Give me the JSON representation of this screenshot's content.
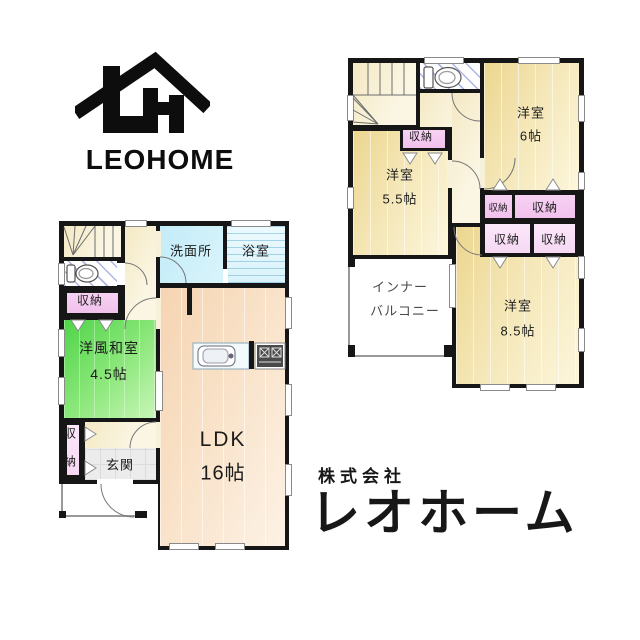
{
  "logo": {
    "brand": "LEOHOME"
  },
  "company": {
    "prefix": "株式会社",
    "name": "レオホーム"
  },
  "labels": {
    "closet": "収納",
    "closet_v_top": "収",
    "closet_v_bottom": "納",
    "washroom": "洗面所",
    "bathroom": "浴室",
    "western_japanese_room": "洋風和室",
    "western_japanese_room_size": "4.5帖",
    "ldk": "LDK",
    "ldk_size": "16帖",
    "entrance": "玄関",
    "bedroom": "洋室",
    "bedroom6_size": "6帖",
    "bedroom55_size": "5.5帖",
    "bedroom85_size": "8.5帖",
    "inner_balcony_line1": "インナー",
    "inner_balcony_line2": "バルコニー"
  },
  "colors": {
    "wall": "#161616",
    "tan_floor": "#f0dd9e",
    "cream_floor": "#f8f0d6",
    "peach_floor": "#f8dec4",
    "green_floor": "#5fdb52",
    "pink_closet": "#f4c9f0",
    "pink_closet_light": "#fae3f8",
    "cyan_washroom": "#c8eef8",
    "bath_blue": "#bfe3f2",
    "hatch_blue": "#7d8bd0",
    "entrance_gray": "#ebebeb",
    "line_gray": "#8a8a8a",
    "text": "#1c1c1c"
  }
}
